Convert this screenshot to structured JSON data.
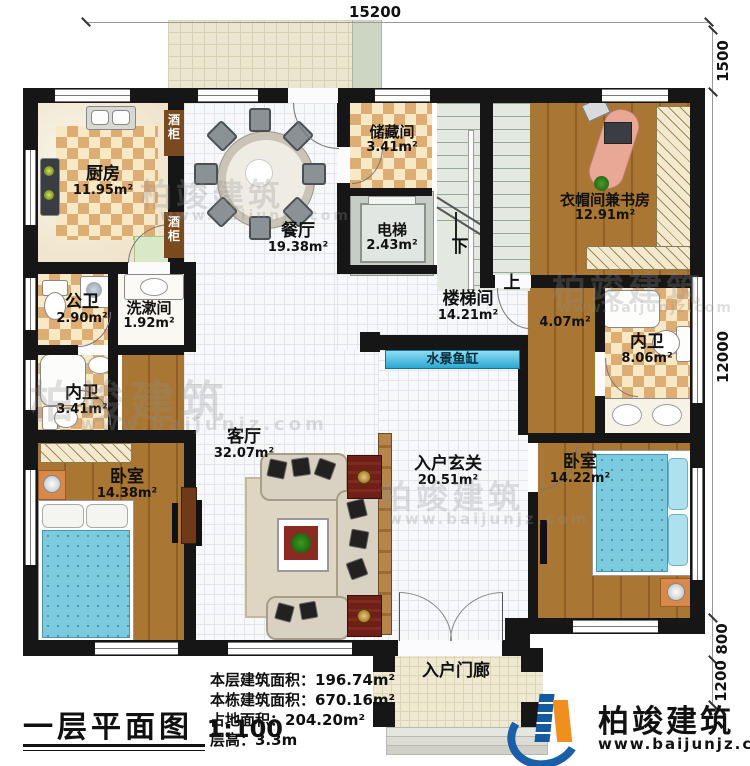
{
  "title_block": {
    "title": "一层平面图",
    "scale": "1:100"
  },
  "stats": {
    "lines": [
      "本层建筑面积：196.74m²",
      "本栋建筑面积：670.16m²",
      "占地面积：204.20m²",
      "层高：3.3m"
    ]
  },
  "dimensions": {
    "top": "15200",
    "right_top": "1500",
    "right_main": "12000",
    "right_step": "800",
    "right_porch": "1200"
  },
  "brand": {
    "name": "柏竣建筑",
    "url": "www.baijunjz.com"
  },
  "watermark": {
    "name": "柏竣建筑",
    "url": "www.baijunjz.com"
  },
  "rooms": {
    "kitchen": {
      "name": "厨房",
      "area": "11.95m²"
    },
    "dining": {
      "name": "餐厅",
      "area": "19.38m²"
    },
    "storage": {
      "name": "储藏间",
      "area": "3.41m²"
    },
    "elevator": {
      "name": "电梯",
      "area": "2.43m²"
    },
    "stairwell": {
      "name": "楼梯间",
      "area": "14.21m²"
    },
    "study": {
      "name": "衣帽间兼书房",
      "area": "12.91m²"
    },
    "corridor": {
      "area": "4.07m²"
    },
    "public_bath": {
      "name": "公卫",
      "area": "2.90m²"
    },
    "washroom": {
      "name": "洗漱间",
      "area": "1.92m²"
    },
    "ensuite_left": {
      "name": "内卫",
      "area": "3.41m²"
    },
    "bedroom_left": {
      "name": "卧室",
      "area": "14.38m²"
    },
    "living": {
      "name": "客厅",
      "area": "32.07m²"
    },
    "foyer": {
      "name": "入户玄关",
      "area": "20.51m²"
    },
    "ensuite_right": {
      "name": "内卫",
      "area": "8.06m²"
    },
    "bedroom_right": {
      "name": "卧室",
      "area": "14.22m²"
    },
    "porch": {
      "name": "入户门廊"
    }
  },
  "features": {
    "aquarium": "水景鱼缸",
    "wine_cabinet": "酒柜",
    "stairs_down": "下",
    "stairs_up": "上"
  }
}
